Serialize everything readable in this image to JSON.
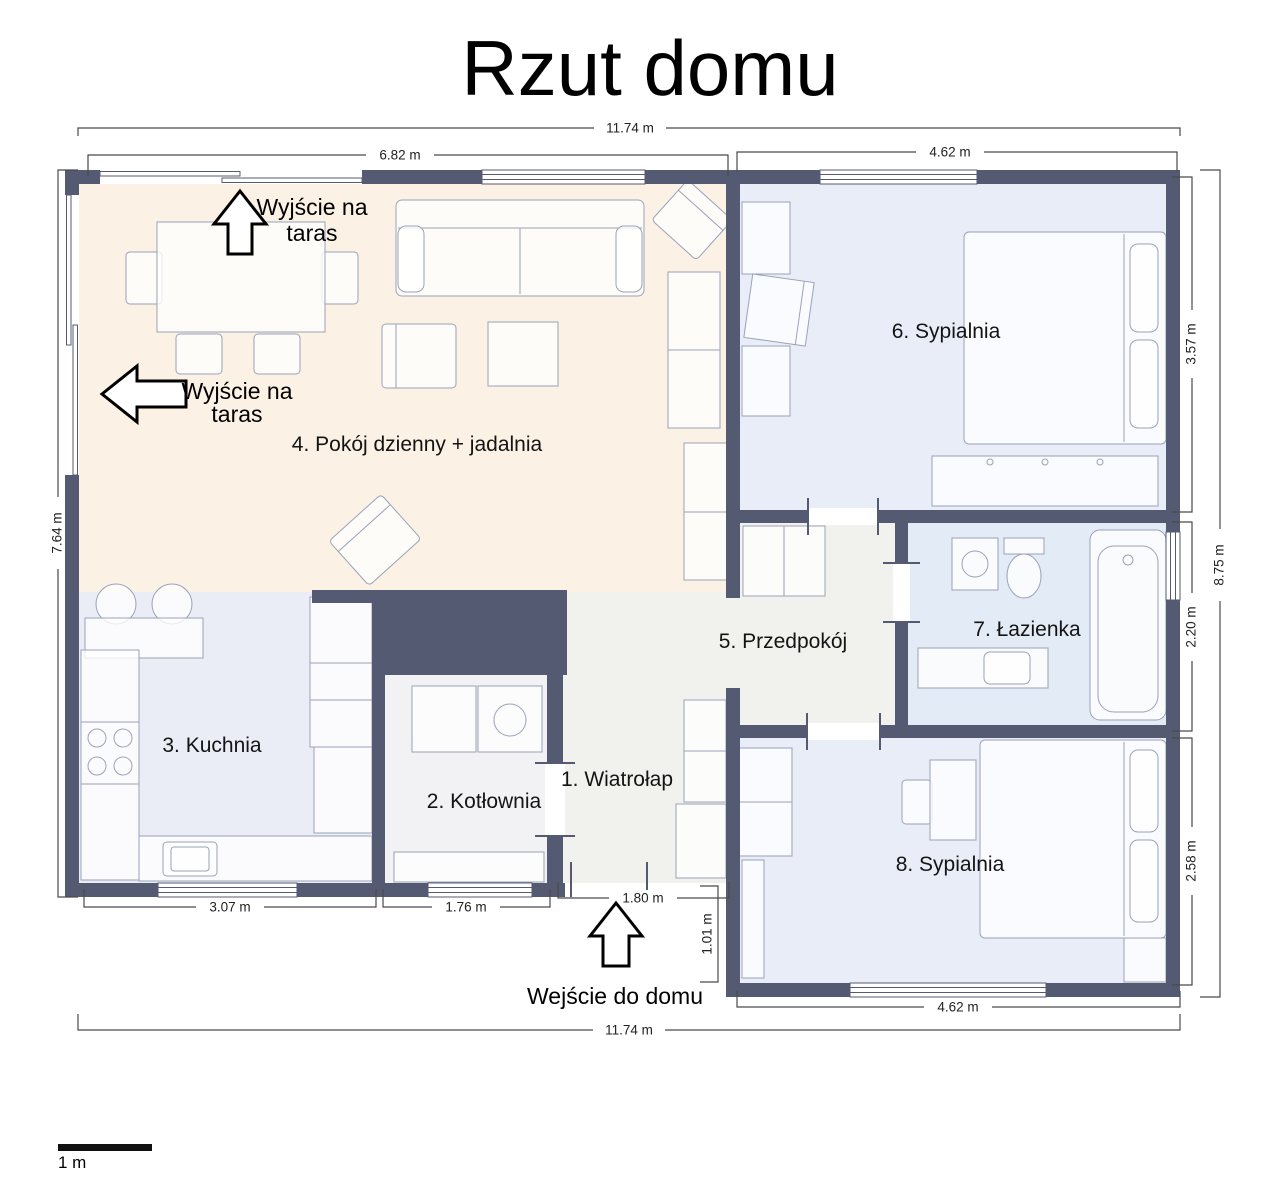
{
  "title": "Rzut domu",
  "scale_bar": {
    "label": "1 m"
  },
  "rooms": {
    "wiatrolap": {
      "label": "1. Wiatrołap"
    },
    "kotlownia": {
      "label": "2. Kotłownia"
    },
    "kuchnia": {
      "label": "3. Kuchnia"
    },
    "pokoj_dzienny": {
      "label": "4. Pokój dzienny + jadalnia"
    },
    "przedpokoj": {
      "label": "5. Przedpokój"
    },
    "sypialnia6": {
      "label": "6. Sypialnia"
    },
    "lazienka": {
      "label": "7. Łazienka"
    },
    "sypialnia8": {
      "label": "8. Sypialnia"
    }
  },
  "dimensions": {
    "top_total": "11.74 m",
    "top_living": "6.82 m",
    "top_bedroom6": "4.62 m",
    "left_total": "7.64 m",
    "right_bedroom6": "3.57 m",
    "right_bathroom": "2.20 m",
    "right_bedroom8": "2.58 m",
    "right_total": "8.75 m",
    "bottom_kitchen": "3.07 m",
    "bottom_boiler": "1.76 m",
    "bottom_entrance": "1.80 m",
    "bottom_offset": "1.01 m",
    "bottom_bedroom8": "4.62 m",
    "bottom_total": "11.74 m"
  },
  "annotations": {
    "terrace_exit_top": {
      "line1": "Wyjście na",
      "line2": "taras"
    },
    "terrace_exit_left": {
      "line1": "Wyjście na",
      "line2": "taras"
    },
    "entrance": {
      "label": "Wejście do domu"
    }
  },
  "colors": {
    "wall": "#545a72",
    "floor_living": "#fbf1e4",
    "floor_kitchen": "#ebedf6",
    "floor_bedroom": "#e9edf8",
    "floor_bathroom": "#e3ebf7",
    "floor_hall": "#f1f1ee",
    "furniture_stroke": "#9aa2b8"
  }
}
